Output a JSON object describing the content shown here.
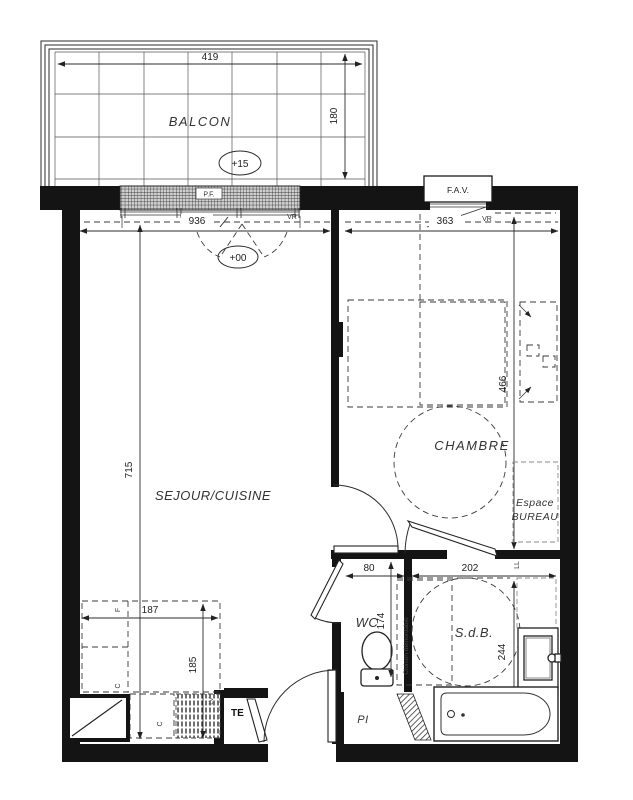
{
  "rooms": {
    "balcon": "BALCON",
    "sejour": "SEJOUR/CUISINE",
    "chambre": "CHAMBRE",
    "wc": "WC",
    "sdb": "S.d.B.",
    "espace_bureau_line1": "Espace",
    "espace_bureau_line2": "BUREAU"
  },
  "levels": {
    "balcon": "+15",
    "sejour": "+00"
  },
  "openings": {
    "pf": "P.F.",
    "fav": "F.A.V.",
    "vr_sejour": "VR",
    "vr_chambre": "VR"
  },
  "equipment": {
    "te": "TE",
    "pi": "PI",
    "ll": "LL",
    "lv": "LV",
    "fridge": "F",
    "hob": "C",
    "oven": "C",
    "cloison": "Cloison démontable"
  },
  "dimensions_cm": {
    "balcon_width": "419",
    "balcon_depth": "180",
    "sejour_width": "936",
    "chambre_width": "363",
    "sejour_depth": "715",
    "chambre_depth": "466",
    "wc_width": "80",
    "sdb_width": "202",
    "wc_depth": "174",
    "sdb_depth": "244",
    "kitchen_width": "187",
    "kitchen_depth": "185"
  },
  "colors": {
    "wall": "#141414",
    "line": "#2b2b2b",
    "muted": "#8a8a8a"
  }
}
